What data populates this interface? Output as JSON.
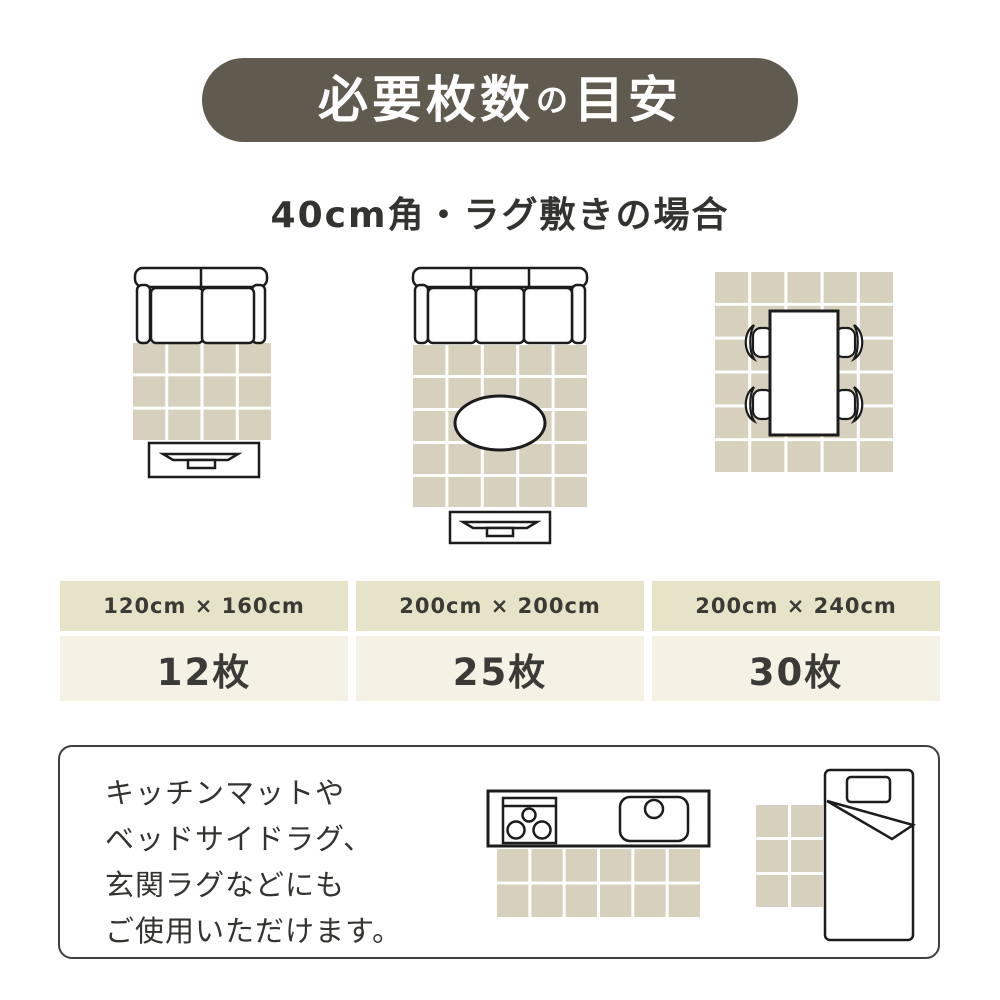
{
  "title": {
    "main1": "必要枚数",
    "particle": "の",
    "main2": "目安"
  },
  "subtitle": "40cm角・ラグ敷きの場合",
  "colors": {
    "title_bg": "#615a4f",
    "title_text": "#ffffff",
    "body_text": "#333330",
    "card_header_bg": "#e7e3c9",
    "card_body_bg": "#f4f2e5",
    "outline": "#1c1c1c"
  },
  "tiles": {
    "color": "#d6d0bd",
    "grout": "#ffffff",
    "tile_size": "40cm角"
  },
  "layouts": [
    {
      "icon": "sofa-2seat-rug-tv",
      "grid": {
        "cols": 4,
        "rows": 3
      },
      "size": "120cm × 160cm",
      "count": "12枚"
    },
    {
      "icon": "sofa-3seat-oval-table-rug-tv",
      "grid": {
        "cols": 5,
        "rows": 5
      },
      "size": "200cm × 200cm",
      "count": "25枚"
    },
    {
      "icon": "dining-table-4chairs-rug",
      "grid": {
        "cols": 5,
        "rows": 6
      },
      "size": "200cm × 240cm",
      "count": "30枚"
    }
  ],
  "note": {
    "lines": [
      "キッチンマットや",
      "ベッドサイドラグ、",
      "玄関ラグなどにも",
      "ご使用いただけます。"
    ],
    "kitchen_mat_grid": {
      "cols": 6,
      "rows": 2
    },
    "bed_mat_grid": {
      "cols": 2,
      "rows": 3
    }
  }
}
